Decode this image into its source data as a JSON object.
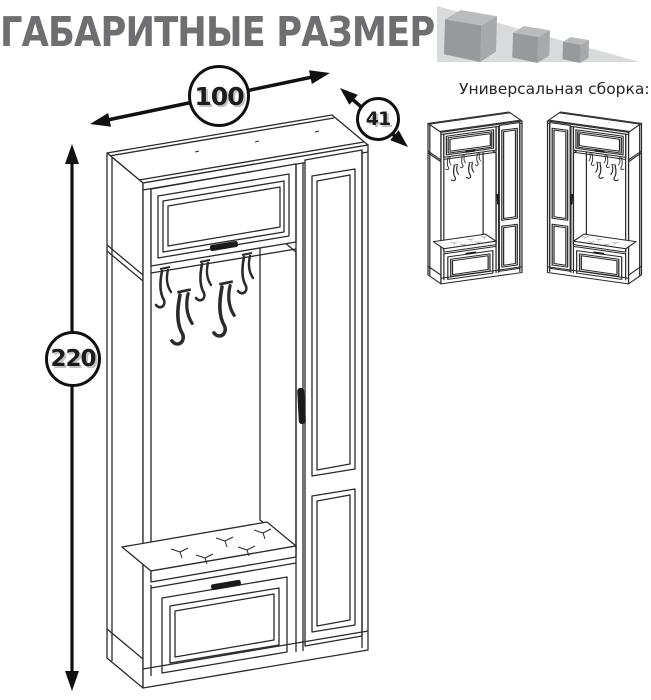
{
  "title": {
    "text": "ГАБАРИТНЫЕ РАЗМЕРЫ",
    "color": "#6f6f71"
  },
  "logo": {
    "icon": "three-cubes-logo",
    "triangle_color": "#d9dadb",
    "cube_top_color": "#babbbd",
    "cube_front_color": "#98999b",
    "cube_side_color": "#a8a9ab"
  },
  "assembly": {
    "label": "Универсальная сборка:"
  },
  "dimensions": {
    "width": "100",
    "depth": "41",
    "height": "220"
  },
  "drawing": {
    "subject": "hallway-wardrobe-technical-drawing",
    "line_color": "#2a2a2a",
    "annotation_color": "#101010"
  }
}
